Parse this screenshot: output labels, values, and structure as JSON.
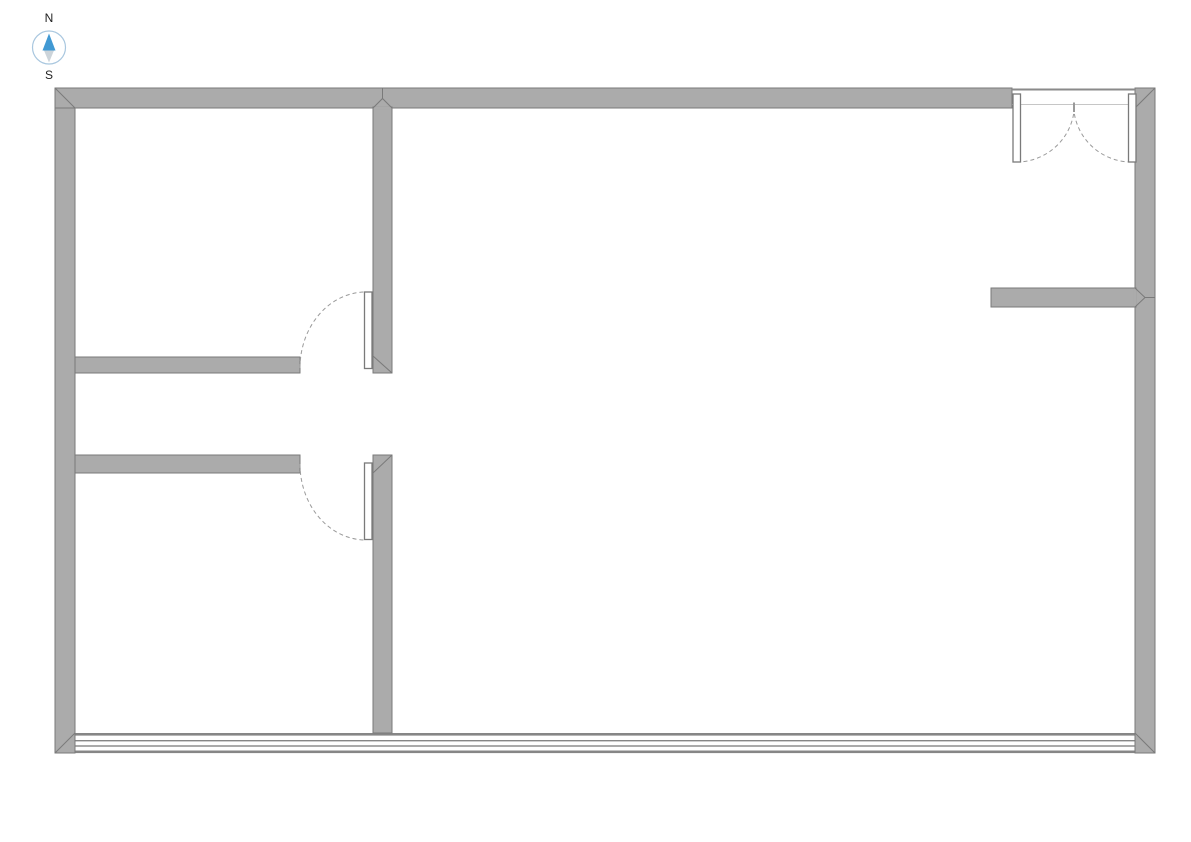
{
  "compass": {
    "north_label": "N",
    "south_label": "S"
  },
  "icons": {
    "compass": "circle-with-up-down-needle"
  },
  "colors": {
    "background": "#ffffff",
    "wall_fill": "#ababab",
    "wall_outline": "#7a7a7a",
    "door_leaf_fill": "#ffffff",
    "swing_arc": "#9a9a9a",
    "window_line": "#868686",
    "double_door_header_line": "#c6c6c6",
    "compass_ring": "#a9c7df",
    "compass_north_needle": "#4199d3",
    "compass_south_needle": "#ccd4da"
  }
}
